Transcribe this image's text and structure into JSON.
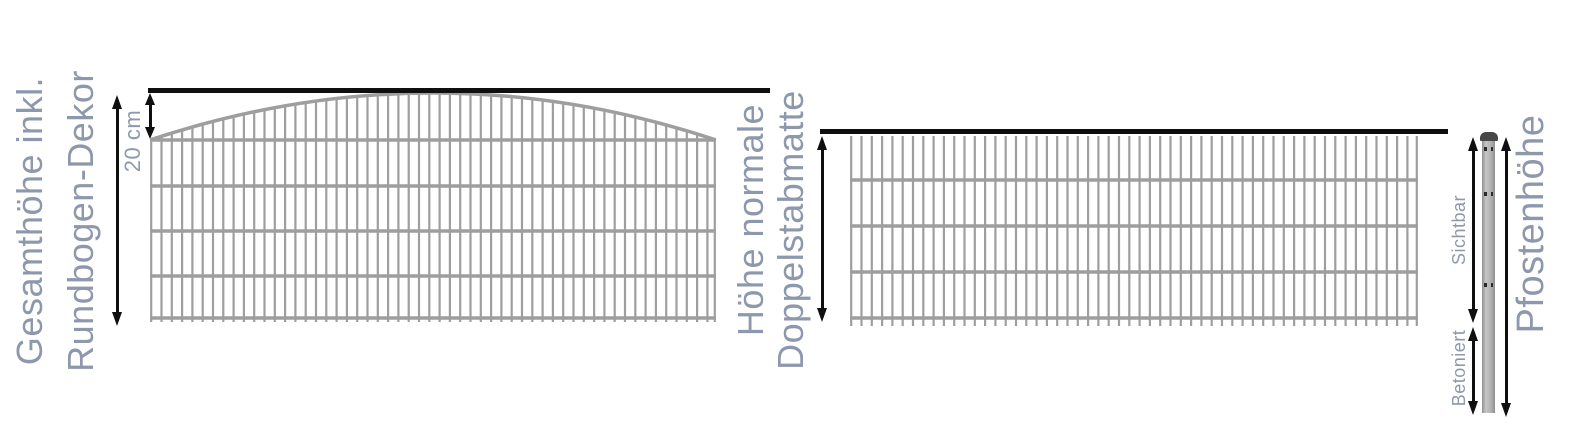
{
  "labels": {
    "left_title_line1": "Gesamthöhe inkl.",
    "left_title_line2": "Rundbogen-Dekor",
    "arch_height": "20 cm",
    "middle_title_line1": "Höhe normale",
    "middle_title_line2": "Doppelstabmatte",
    "post_visible": "Sichtbar",
    "post_concreted": "Betoniert",
    "post_height": "Pfostenhöhe"
  },
  "colors": {
    "label": "#8e98ac",
    "mesh": "#9e9e9e",
    "line": "#0f0f0f",
    "post-body": "#b3b3b3",
    "post-cap": "#474747",
    "post-clip": "#2b2b2b",
    "bg": "#ffffff"
  },
  "fences": {
    "arched": {
      "x": 150,
      "y": 93,
      "width": 566,
      "height": 233,
      "type": "arched",
      "arch_rise": 47,
      "rail_ys": [
        47,
        93,
        138,
        183,
        225
      ],
      "bar_spacing": 10.3,
      "bar_bottom": 229
    },
    "flat": {
      "x": 850,
      "y": 134,
      "width": 568,
      "height": 196,
      "type": "flat",
      "rail_ys": [
        46,
        92,
        138,
        184
      ],
      "bar_spacing": 10.3,
      "bar_top": 2,
      "bar_bottom": 192
    }
  }
}
